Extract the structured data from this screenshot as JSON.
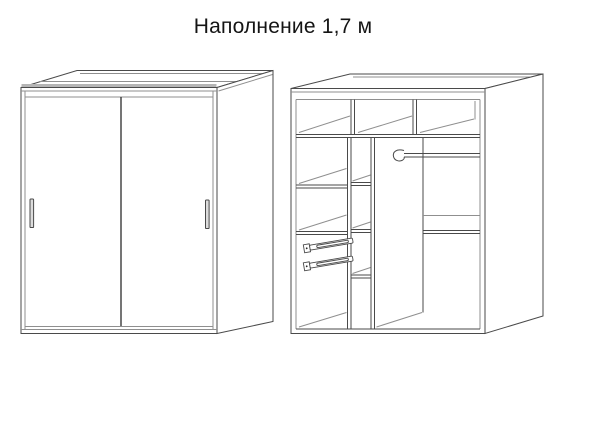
{
  "title": "Наполнение 1,7 м",
  "colors": {
    "background": "#ffffff",
    "line": "#4a4a4a",
    "line_light": "#8f8f8f",
    "line_dark": "#2b2b2b",
    "top_edge_shade": "#b5b5b5",
    "handle_fill": "#dcdcdc",
    "title_text": "#141414"
  }
}
